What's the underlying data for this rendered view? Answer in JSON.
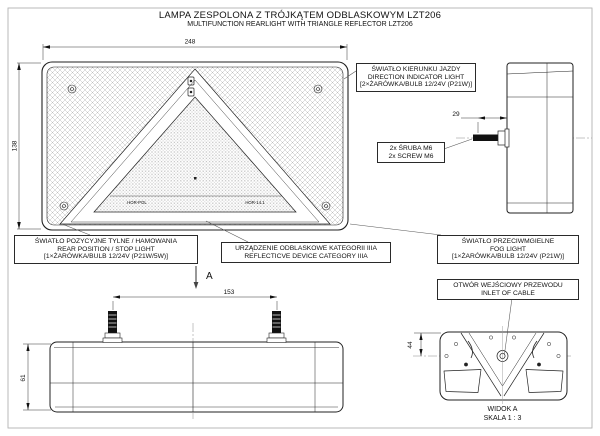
{
  "title": {
    "pl": "LAMPA ZESPOLONA Z TRÓJKĄTEM ODBLASKOWYM LZT206",
    "en": "MULTIFUNCTION REARLIGHT WITH TRIANGLE REFLECTOR LZT206"
  },
  "callouts": {
    "direction": {
      "pl": "ŚWIATŁO KIERUNKU JAZDY",
      "en": "DIRECTION INDICATOR LIGHT",
      "bulb": "[2×ŻARÓWKA/BULB 12/24V (P21W)]"
    },
    "screws": {
      "pl": "2x ŚRUBA M6",
      "en": "2x SCREW M6"
    },
    "stop": {
      "pl": "ŚWIATŁO POZYCYJNE TYLNE / HAMOWANIA",
      "en": "REAR POSITION / STOP LIGHT",
      "bulb": "[1×ŻARÓWKA/BULB 12/24V (P21W/5W)]"
    },
    "reflective": {
      "pl": "URZĄDZENIE ODBLASKOWE KATEGORII IIIA",
      "en": "REFLECTICVE DEVICE CATEGORY IIIA"
    },
    "fog": {
      "pl": "ŚWIATŁO PRZECIWMGIELNE",
      "en": "FOG LIGHT",
      "bulb": "[1×ŻARÓWKA/BULB 12/24V (P21W)]"
    },
    "inlet": {
      "pl": "OTWÓR WEJŚCIOWY PRZEWODU",
      "en": "INLET OF CABLE"
    }
  },
  "dims": {
    "width": "248",
    "height": "138",
    "screw": "29",
    "studs": "153",
    "bottom_height": "61",
    "inlet": "44"
  },
  "views": {
    "bottom": {
      "arrow_label": "A"
    },
    "view_a": {
      "title": "WIDOK A",
      "scale": "SKALA 1 : 3"
    }
  },
  "markings": {
    "left": "HOR-POL",
    "right": "HOR-14.1"
  },
  "colors": {
    "line": "#222222",
    "hatch": "#b5b5b5",
    "centerline": "#888888",
    "frame": "#b3b3b3",
    "background": "#ffffff"
  }
}
